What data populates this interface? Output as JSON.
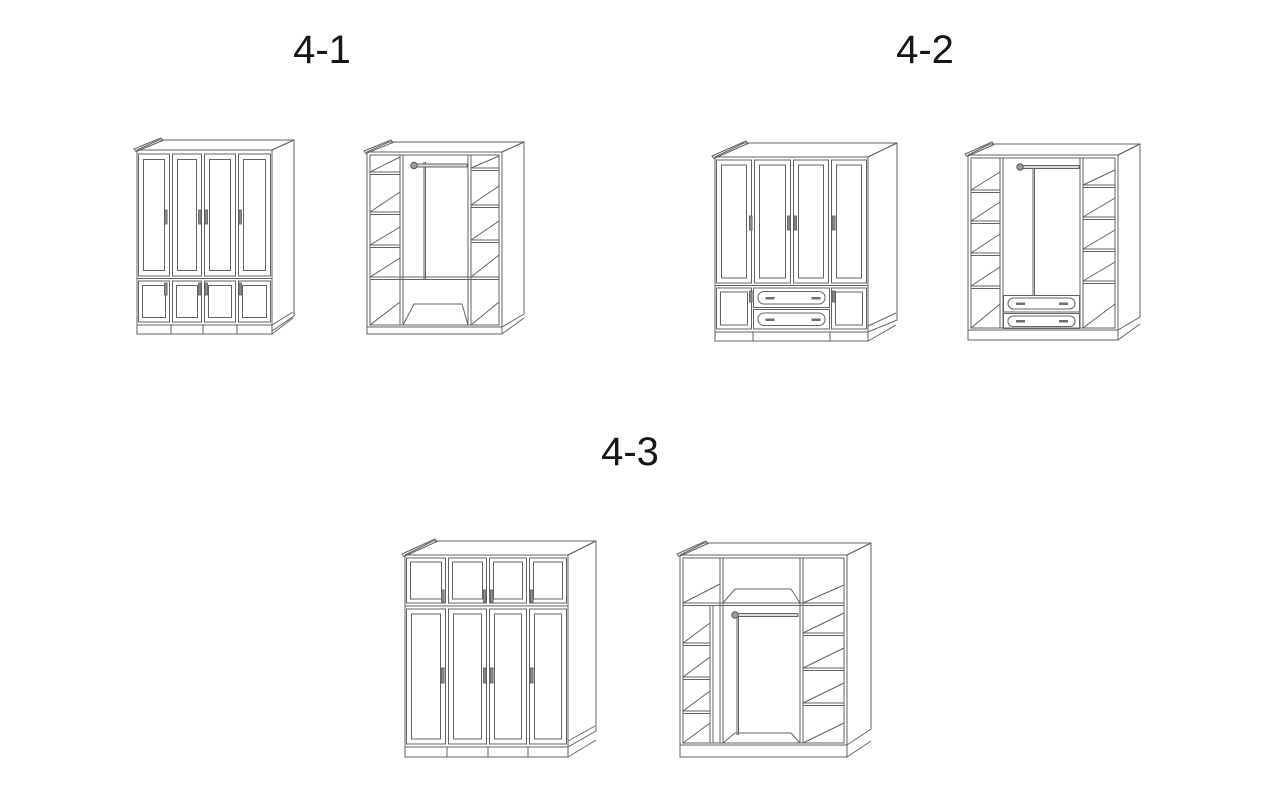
{
  "page": {
    "background_color": "#ffffff",
    "line_color": "#636363",
    "label_color": "#161616",
    "handle_color": "#8e8e8e"
  },
  "figures": [
    {
      "label": "4-1",
      "views": [
        {
          "name": "closed-wardrobe-four-tall-doors-four-small-lower-doors"
        },
        {
          "name": "interior-two-shelf-columns-center-hanging-rod-open-bottom-row"
        }
      ]
    },
    {
      "label": "4-2",
      "views": [
        {
          "name": "closed-wardrobe-four-tall-doors-two-small-lower-doors-two-center-drawers"
        },
        {
          "name": "interior-two-shelf-columns-center-hanging-rod-two-center-drawers"
        }
      ]
    },
    {
      "label": "4-3",
      "views": [
        {
          "name": "closed-wardrobe-four-small-top-doors-four-tall-doors"
        },
        {
          "name": "interior-top-shelf-row-two-shelf-columns-center-hanging-rod"
        }
      ]
    }
  ]
}
